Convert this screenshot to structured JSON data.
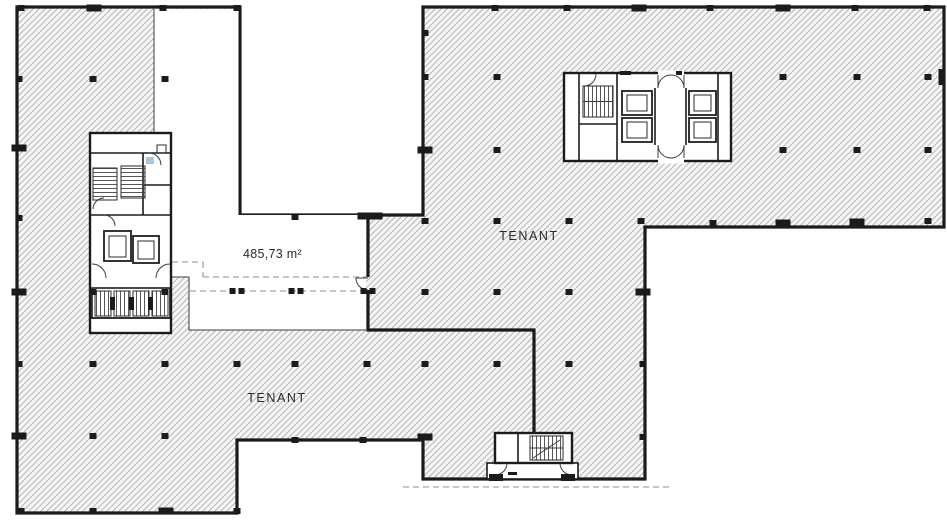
{
  "plan": {
    "labels": {
      "tenant_upper": "TENANT",
      "tenant_lower": "TENANT",
      "vacant_area": "485,73 m²"
    },
    "colors": {
      "wall": "#1b1b1b",
      "thin_line": "#3c3c3c",
      "hatch_line": "#b7b7b7",
      "hatch_bg": "#f6f6f6",
      "white": "#ffffff",
      "dashed": "#8f8f8f",
      "accent_blue": "#a9c7dd",
      "text": "#2b2b2b"
    },
    "columns": [
      [
        21,
        8,
        "s"
      ],
      [
        94,
        8,
        "w"
      ],
      [
        163,
        8,
        "s"
      ],
      [
        237,
        8,
        "s"
      ],
      [
        495,
        8,
        "s"
      ],
      [
        567,
        8,
        "s"
      ],
      [
        639,
        8,
        "w"
      ],
      [
        710,
        8,
        "s"
      ],
      [
        783,
        8,
        "w"
      ],
      [
        855,
        8,
        "s"
      ],
      [
        927,
        8,
        "s"
      ],
      [
        19,
        79,
        "s"
      ],
      [
        19,
        148,
        "w"
      ],
      [
        19,
        218,
        "s"
      ],
      [
        19,
        292,
        "w"
      ],
      [
        19,
        364,
        "s"
      ],
      [
        19,
        436,
        "w"
      ],
      [
        93,
        79,
        "s"
      ],
      [
        165,
        79,
        "s"
      ],
      [
        93,
        292,
        "s"
      ],
      [
        165,
        292,
        "s"
      ],
      [
        93,
        364,
        "s"
      ],
      [
        165,
        364,
        "s"
      ],
      [
        93,
        436,
        "s"
      ],
      [
        165,
        436,
        "s"
      ],
      [
        21,
        511,
        "s"
      ],
      [
        93,
        511,
        "s"
      ],
      [
        166,
        511,
        "w"
      ],
      [
        237,
        511,
        "s"
      ],
      [
        295,
        217,
        "s"
      ],
      [
        370,
        216,
        "W"
      ],
      [
        237,
        291,
        "d"
      ],
      [
        296,
        291,
        "d"
      ],
      [
        368,
        291,
        "d"
      ],
      [
        295,
        440,
        "s"
      ],
      [
        363,
        440,
        "s"
      ],
      [
        237,
        364,
        "s"
      ],
      [
        295,
        364,
        "s"
      ],
      [
        367,
        364,
        "s"
      ],
      [
        425,
        33,
        "s"
      ],
      [
        425,
        77,
        "s"
      ],
      [
        425,
        150,
        "w"
      ],
      [
        425,
        221,
        "s"
      ],
      [
        425,
        292,
        "s"
      ],
      [
        425,
        364,
        "s"
      ],
      [
        425,
        437,
        "w"
      ],
      [
        497,
        77,
        "s"
      ],
      [
        497,
        150,
        "s"
      ],
      [
        497,
        221,
        "s"
      ],
      [
        497,
        292,
        "s"
      ],
      [
        497,
        364,
        "s"
      ],
      [
        569,
        221,
        "s"
      ],
      [
        569,
        292,
        "s"
      ],
      [
        569,
        364,
        "s"
      ],
      [
        641,
        221,
        "s"
      ],
      [
        643,
        292,
        "w"
      ],
      [
        643,
        364,
        "s"
      ],
      [
        643,
        437,
        "s"
      ],
      [
        713,
        223,
        "s"
      ],
      [
        783,
        223,
        "w"
      ],
      [
        857,
        222,
        "w"
      ],
      [
        928,
        221,
        "s"
      ],
      [
        783,
        77,
        "s"
      ],
      [
        857,
        77,
        "s"
      ],
      [
        928,
        77,
        "s"
      ],
      [
        783,
        150,
        "s"
      ],
      [
        857,
        150,
        "s"
      ],
      [
        928,
        150,
        "s"
      ],
      [
        941,
        77,
        "v"
      ]
    ],
    "dashed_lines": [
      {
        "x1": 172,
        "y1": 262,
        "x2": 203,
        "y2": 262
      },
      {
        "x1": 203,
        "y1": 262,
        "x2": 203,
        "y2": 277
      },
      {
        "x1": 203,
        "y1": 277,
        "x2": 366,
        "y2": 277
      },
      {
        "x1": 190,
        "y1": 291,
        "x2": 366,
        "y2": 291
      },
      {
        "x1": 403,
        "y1": 487,
        "x2": 670,
        "y2": 487
      }
    ]
  }
}
